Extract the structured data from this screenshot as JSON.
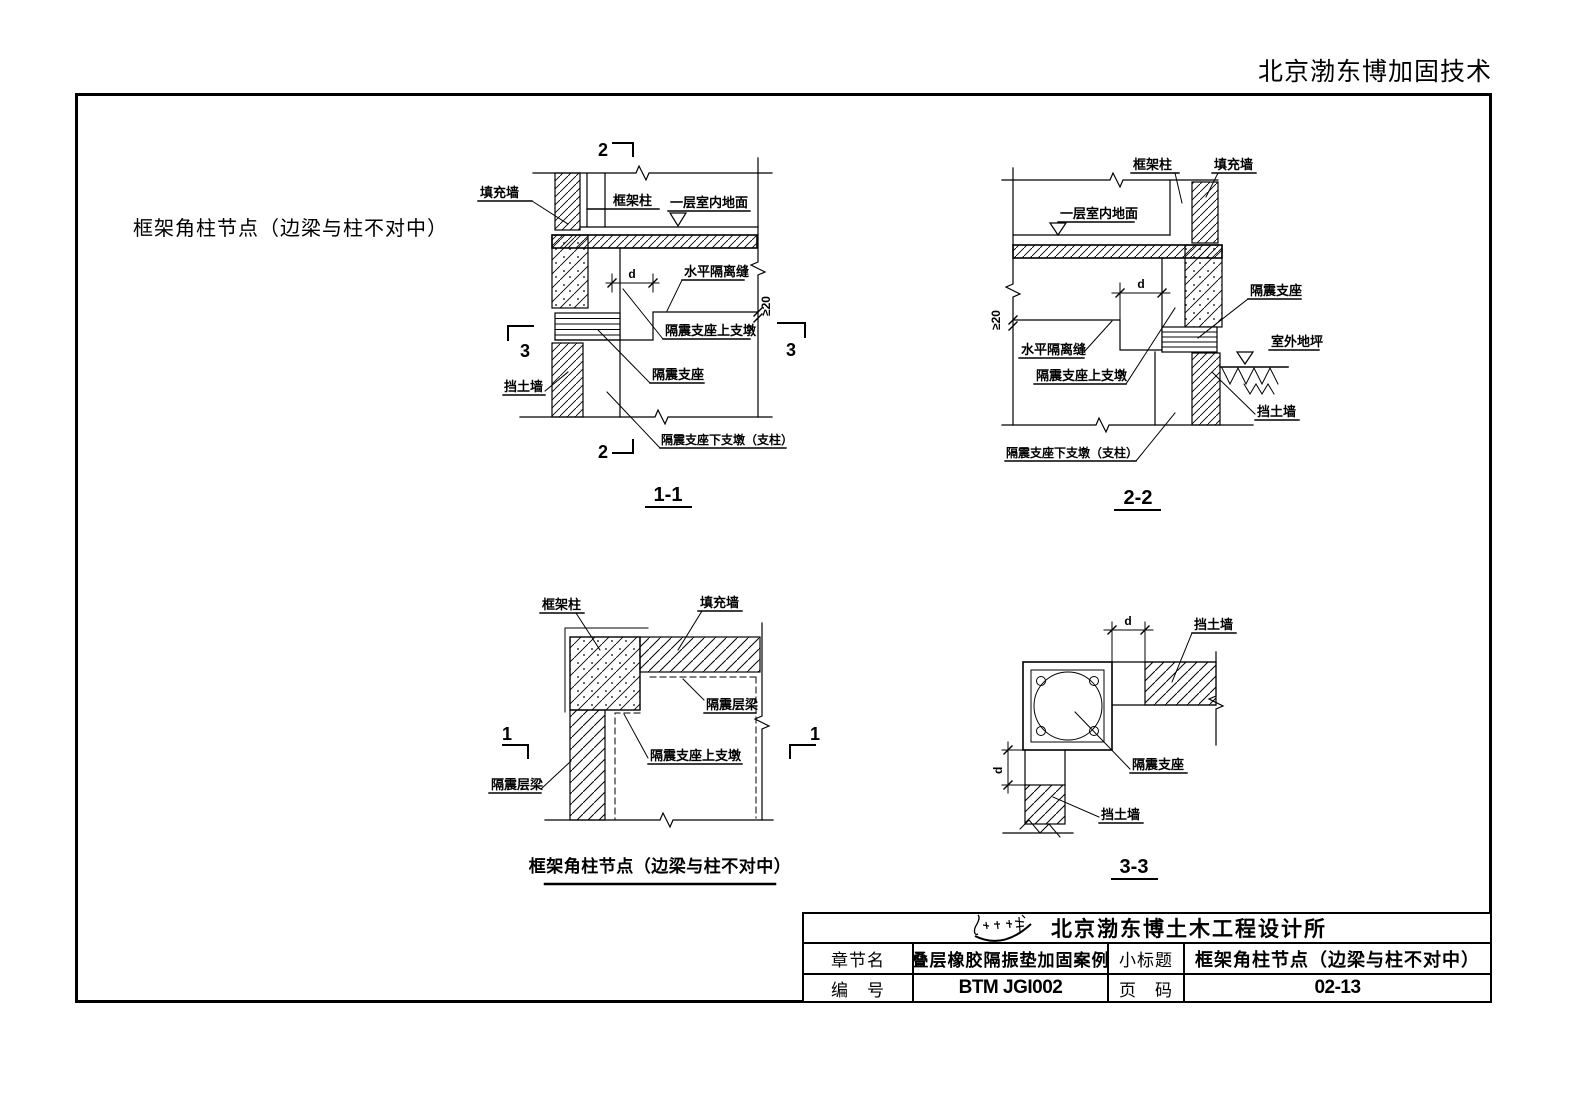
{
  "header": {
    "company": "北京渤东博加固技术"
  },
  "page_title": "框架角柱节点（边梁与柱不对中）",
  "labels": {
    "fill_wall": "填充墙",
    "frame_column": "框架柱",
    "floor_surface": "一层室内地面",
    "horizontal_seam": "水平隔离缝",
    "upper_pier": "隔震支座上支墩",
    "bearing": "隔震支座",
    "retaining_wall": "挡土墙",
    "lower_pier": "隔震支座下支墩（支柱）",
    "isolation_beam": "隔震层梁",
    "outdoor_ground": "室外地坪",
    "dim_d": "d",
    "dim_ge20": "≥20"
  },
  "section_marks": {
    "s1": "1",
    "s2": "2",
    "s3": "3"
  },
  "view_titles": {
    "v11": "1-1",
    "v22": "2-2",
    "v33": "3-3",
    "plan_caption": "框架角柱节点（边梁与柱不对中）"
  },
  "title_block": {
    "institute": "北京渤东博土木工程设计所",
    "chapter_label": "章节名",
    "chapter_value": "叠层橡胶隔振垫加固案例",
    "subtitle_label": "小标题",
    "subtitle_value": "框架角柱节点（边梁与柱不对中）",
    "number_label": "编　号",
    "number_value": "BTM JGI002",
    "page_label": "页　码",
    "page_value": "02-13"
  }
}
